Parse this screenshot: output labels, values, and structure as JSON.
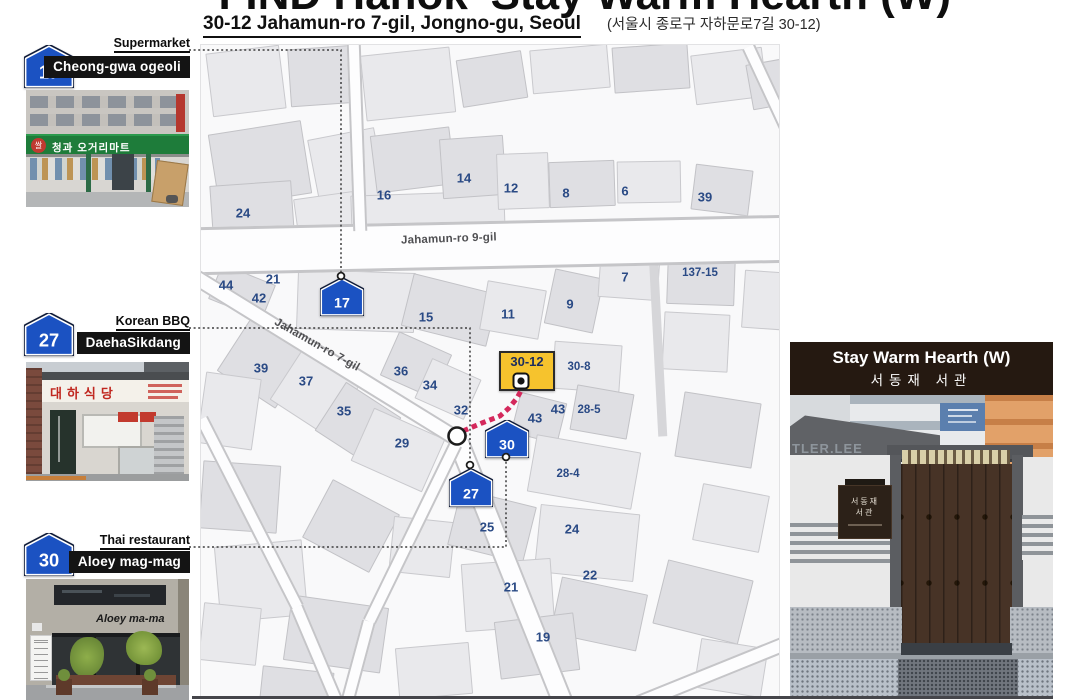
{
  "page": {
    "title": "FIND Hanok 'Stay Warm Hearth (W)'"
  },
  "address": {
    "en": "30-12 Jahamun-ro 7-gil, Jongno-gu, Seoul",
    "kr": "(서울시 종로구 자하문로7길 30-12)"
  },
  "colors": {
    "marker_blue": "#1b52c2",
    "marker_outline": "#0f1b38",
    "map_label_navy": "#2a4a85",
    "destination_yellow": "#f6c32d",
    "route_pink": "#d4295c",
    "panel_brown": "#251911",
    "name_box_black": "#141414"
  },
  "sidebar": {
    "items": [
      {
        "number": "17",
        "category": "Supermarket",
        "name": "Cheong-gwa ogeoli",
        "sign": "청과 오거리마트",
        "sign_badge": "쌀"
      },
      {
        "number": "27",
        "category": "Korean BBQ",
        "name": "DaehaSikdang",
        "sign": "대하식당"
      },
      {
        "number": "30",
        "category": "Thai restaurant",
        "name": "Aloey mag-mag",
        "sign": "Aloey ma-ma"
      }
    ]
  },
  "map": {
    "street_labels": [
      {
        "text": "Jahamun-ro 9-gil",
        "x": 200,
        "y": 188
      },
      {
        "text": "Jahamun-ro 7-gil",
        "x": 68,
        "y": 294
      }
    ],
    "building_labels": [
      {
        "text": "24",
        "x": 42,
        "y": 168
      },
      {
        "text": "16",
        "x": 183,
        "y": 150
      },
      {
        "text": "14",
        "x": 263,
        "y": 133
      },
      {
        "text": "12",
        "x": 310,
        "y": 143
      },
      {
        "text": "8",
        "x": 365,
        "y": 148
      },
      {
        "text": "6",
        "x": 424,
        "y": 146
      },
      {
        "text": "39",
        "x": 504,
        "y": 152
      },
      {
        "text": "7",
        "x": 424,
        "y": 232
      },
      {
        "text": "137-15",
        "x": 499,
        "y": 228
      },
      {
        "text": "44",
        "x": 25,
        "y": 240
      },
      {
        "text": "21",
        "x": 72,
        "y": 234
      },
      {
        "text": "42",
        "x": 58,
        "y": 253
      },
      {
        "text": "15",
        "x": 225,
        "y": 272
      },
      {
        "text": "11",
        "x": 307,
        "y": 269
      },
      {
        "text": "9",
        "x": 369,
        "y": 259
      },
      {
        "text": "36",
        "x": 200,
        "y": 326
      },
      {
        "text": "34",
        "x": 229,
        "y": 340
      },
      {
        "text": "37",
        "x": 105,
        "y": 336
      },
      {
        "text": "39",
        "x": 60,
        "y": 323
      },
      {
        "text": "35",
        "x": 143,
        "y": 366
      },
      {
        "text": "32",
        "x": 260,
        "y": 365
      },
      {
        "text": "29",
        "x": 201,
        "y": 398
      },
      {
        "text": "30-8",
        "x": 378,
        "y": 322
      },
      {
        "text": "43",
        "x": 334,
        "y": 373
      },
      {
        "text": "43",
        "x": 357,
        "y": 364
      },
      {
        "text": "28-5",
        "x": 388,
        "y": 365
      },
      {
        "text": "28-4",
        "x": 367,
        "y": 429
      },
      {
        "text": "25",
        "x": 286,
        "y": 482
      },
      {
        "text": "24",
        "x": 371,
        "y": 484
      },
      {
        "text": "22",
        "x": 389,
        "y": 530
      },
      {
        "text": "21",
        "x": 310,
        "y": 542
      },
      {
        "text": "19",
        "x": 342,
        "y": 592
      }
    ],
    "markers": [
      {
        "number": "17",
        "x": 141,
        "y": 252
      },
      {
        "number": "27",
        "x": 270,
        "y": 443
      },
      {
        "number": "30",
        "x": 306,
        "y": 394
      }
    ],
    "destination_label": "30-12"
  },
  "right_panel": {
    "title_en": "Stay Warm Hearth (W)",
    "title_kr": "서동재 서관",
    "wall_text": "TLER.LEE",
    "door_sign_line1": "서동재",
    "door_sign_line2": "서관"
  }
}
